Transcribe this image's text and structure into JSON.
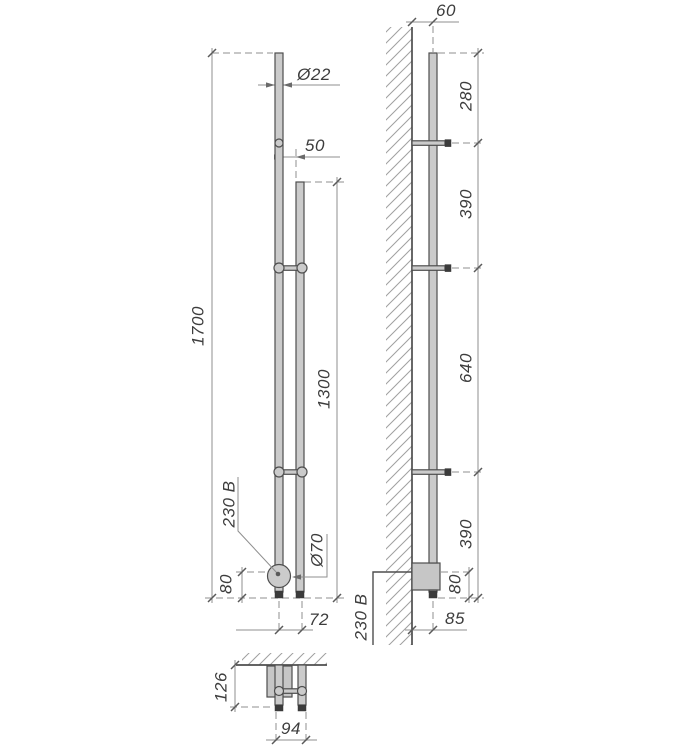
{
  "drawing": {
    "colors": {
      "object_line": "#4e4e4e",
      "fill_metal": "#cbcbcb",
      "dimension_line": "#8f8f8f",
      "text": "#3d3d3d"
    },
    "front_view": {
      "overall_height": "1700",
      "rail_height": "1300",
      "tube_diameter": "Ø22",
      "tube_gap": "50",
      "voltage": "230 В",
      "unit_diameter": "Ø70",
      "unit_bottom_offset": "80",
      "tube_axis_spacing": "72"
    },
    "side_view": {
      "wall_offset": "60",
      "segments": [
        "280",
        "390",
        "640",
        "390"
      ],
      "bottom_offset": "80",
      "wall_depth": "85",
      "voltage": "230 В"
    },
    "top_view": {
      "depth": "126",
      "width": "94"
    }
  }
}
